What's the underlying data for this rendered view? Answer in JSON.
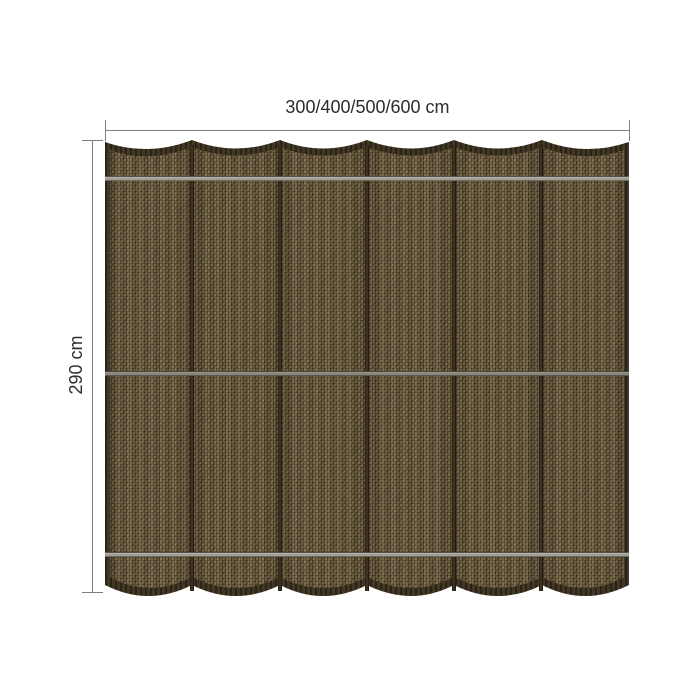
{
  "diagram": {
    "type": "product-dimension-diagram",
    "subject": "woven shade cloth / harmonica canopy, brown fabric with 6 panels, 5 vertical seams and 3 horizontal support rods, scalloped top and bottom edges",
    "dimensions": {
      "width_label": "300/400/500/600 cm",
      "height_label": "290 cm"
    },
    "panel_count": 6,
    "seam_count": 5,
    "rod_count": 3,
    "colors": {
      "background": "#ffffff",
      "text": "#2d2d2d",
      "dimension_line": "#7f7f7f",
      "fabric_weave_base": "#6f5f42",
      "fabric_border": "#3a3021",
      "seam": "#2e2517",
      "rod_light": "#a09f95",
      "rod_dark": "#87867b"
    }
  }
}
